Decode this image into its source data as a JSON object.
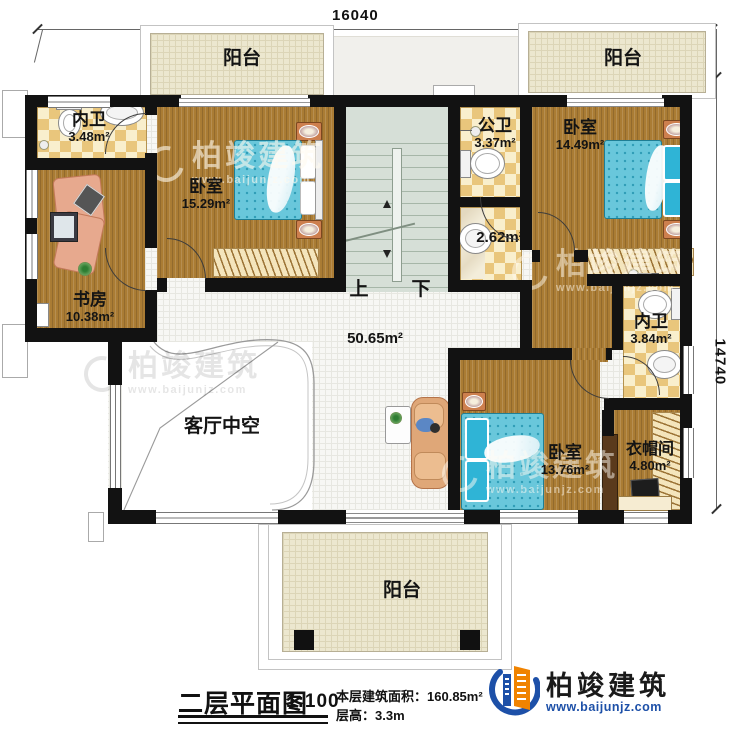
{
  "dims": {
    "top": "16040",
    "right": "14740"
  },
  "rooms": {
    "bath_tl": {
      "name": "内卫",
      "area": "3.48m²"
    },
    "study": {
      "name": "书房",
      "area": "10.38m²"
    },
    "bedroom_left": {
      "name": "卧室",
      "area": "15.29m²"
    },
    "balcony_tl": {
      "name": "阳台"
    },
    "balcony_tr": {
      "name": "阳台"
    },
    "balcony_bottom": {
      "name": "阳台"
    },
    "public_bath": {
      "name": "公卫",
      "area": "3.37m²"
    },
    "washroom": {
      "area": "2.62m²"
    },
    "bedroom_right": {
      "name": "卧室",
      "area": "14.49m²"
    },
    "bath_right": {
      "name": "内卫",
      "area": "3.84m²"
    },
    "hall": {
      "area": "50.65m²"
    },
    "living_void": {
      "name": "客厅中空"
    },
    "bedroom_bottom": {
      "name": "卧室",
      "area": "13.76m²"
    },
    "cloakroom": {
      "name": "衣帽间",
      "area": "4.80m²"
    }
  },
  "stairs": {
    "up": "上",
    "down": "下"
  },
  "titleblock": {
    "title": "二层平面图",
    "scale": "1:100",
    "area_label": "本层建筑面积：",
    "area_value": "160.85m²",
    "height_label": "层高：",
    "height_value": "3.3m"
  },
  "brand": {
    "name": "柏竣建筑",
    "url": "www.baijunjz.com"
  }
}
